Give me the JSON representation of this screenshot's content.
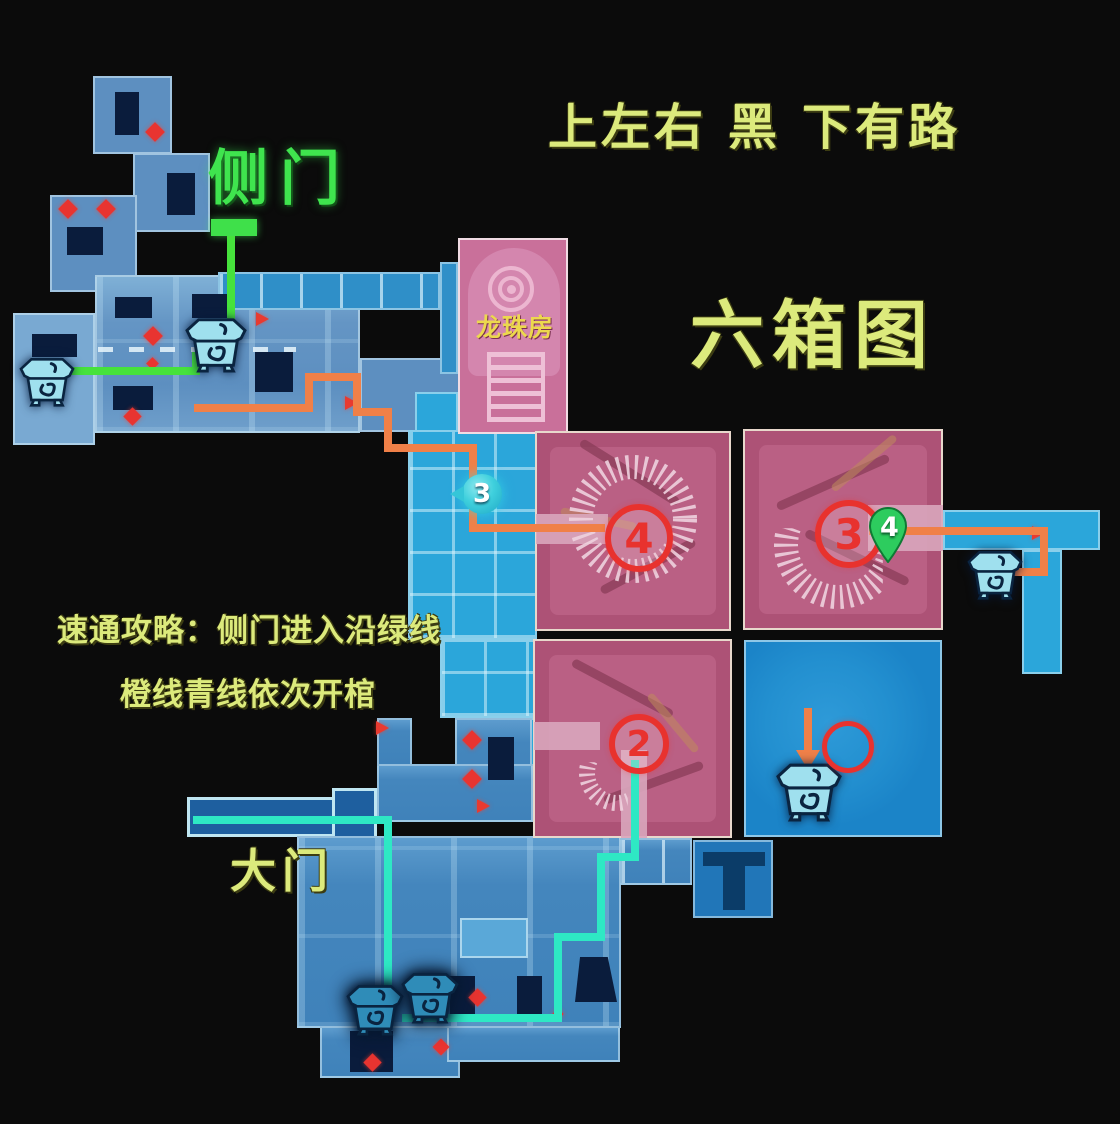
{
  "title": "六箱图",
  "annotations": {
    "top_hint": "上左右 黑 下有路",
    "side_door_label": "侧门",
    "main_gate_label": "大门",
    "dragon_room_label": "龙珠房",
    "guide_line1": "速通攻略：侧门进入沿绿线",
    "guide_line2": "橙线青线依次开棺"
  },
  "markers": {
    "cyan_step": "3",
    "red_step_4": "4",
    "red_step_3": "3",
    "red_step_2": "2",
    "green_pin": "4"
  },
  "palette": {
    "background": "#0b0b0b",
    "map_blue": "#5d8fc0",
    "map_blue_bright": "#2ba6da",
    "map_blue_deep": "#1b84c8",
    "room_pink": "#ad5276",
    "room_pink_light": "#d9a6bc",
    "dragon_room_pink": "#c9709a",
    "hole_navy": "#0a1c3c",
    "marker_red": "#e8322e",
    "route_green": "#46e23c",
    "route_orange": "#f08048",
    "route_cyan": "#2ee8c4",
    "text_yellow": "#dcea7c",
    "text_green": "#3fe44e",
    "chest_teal": "#9fe0ee",
    "pin_green": "#2dcc5e"
  }
}
